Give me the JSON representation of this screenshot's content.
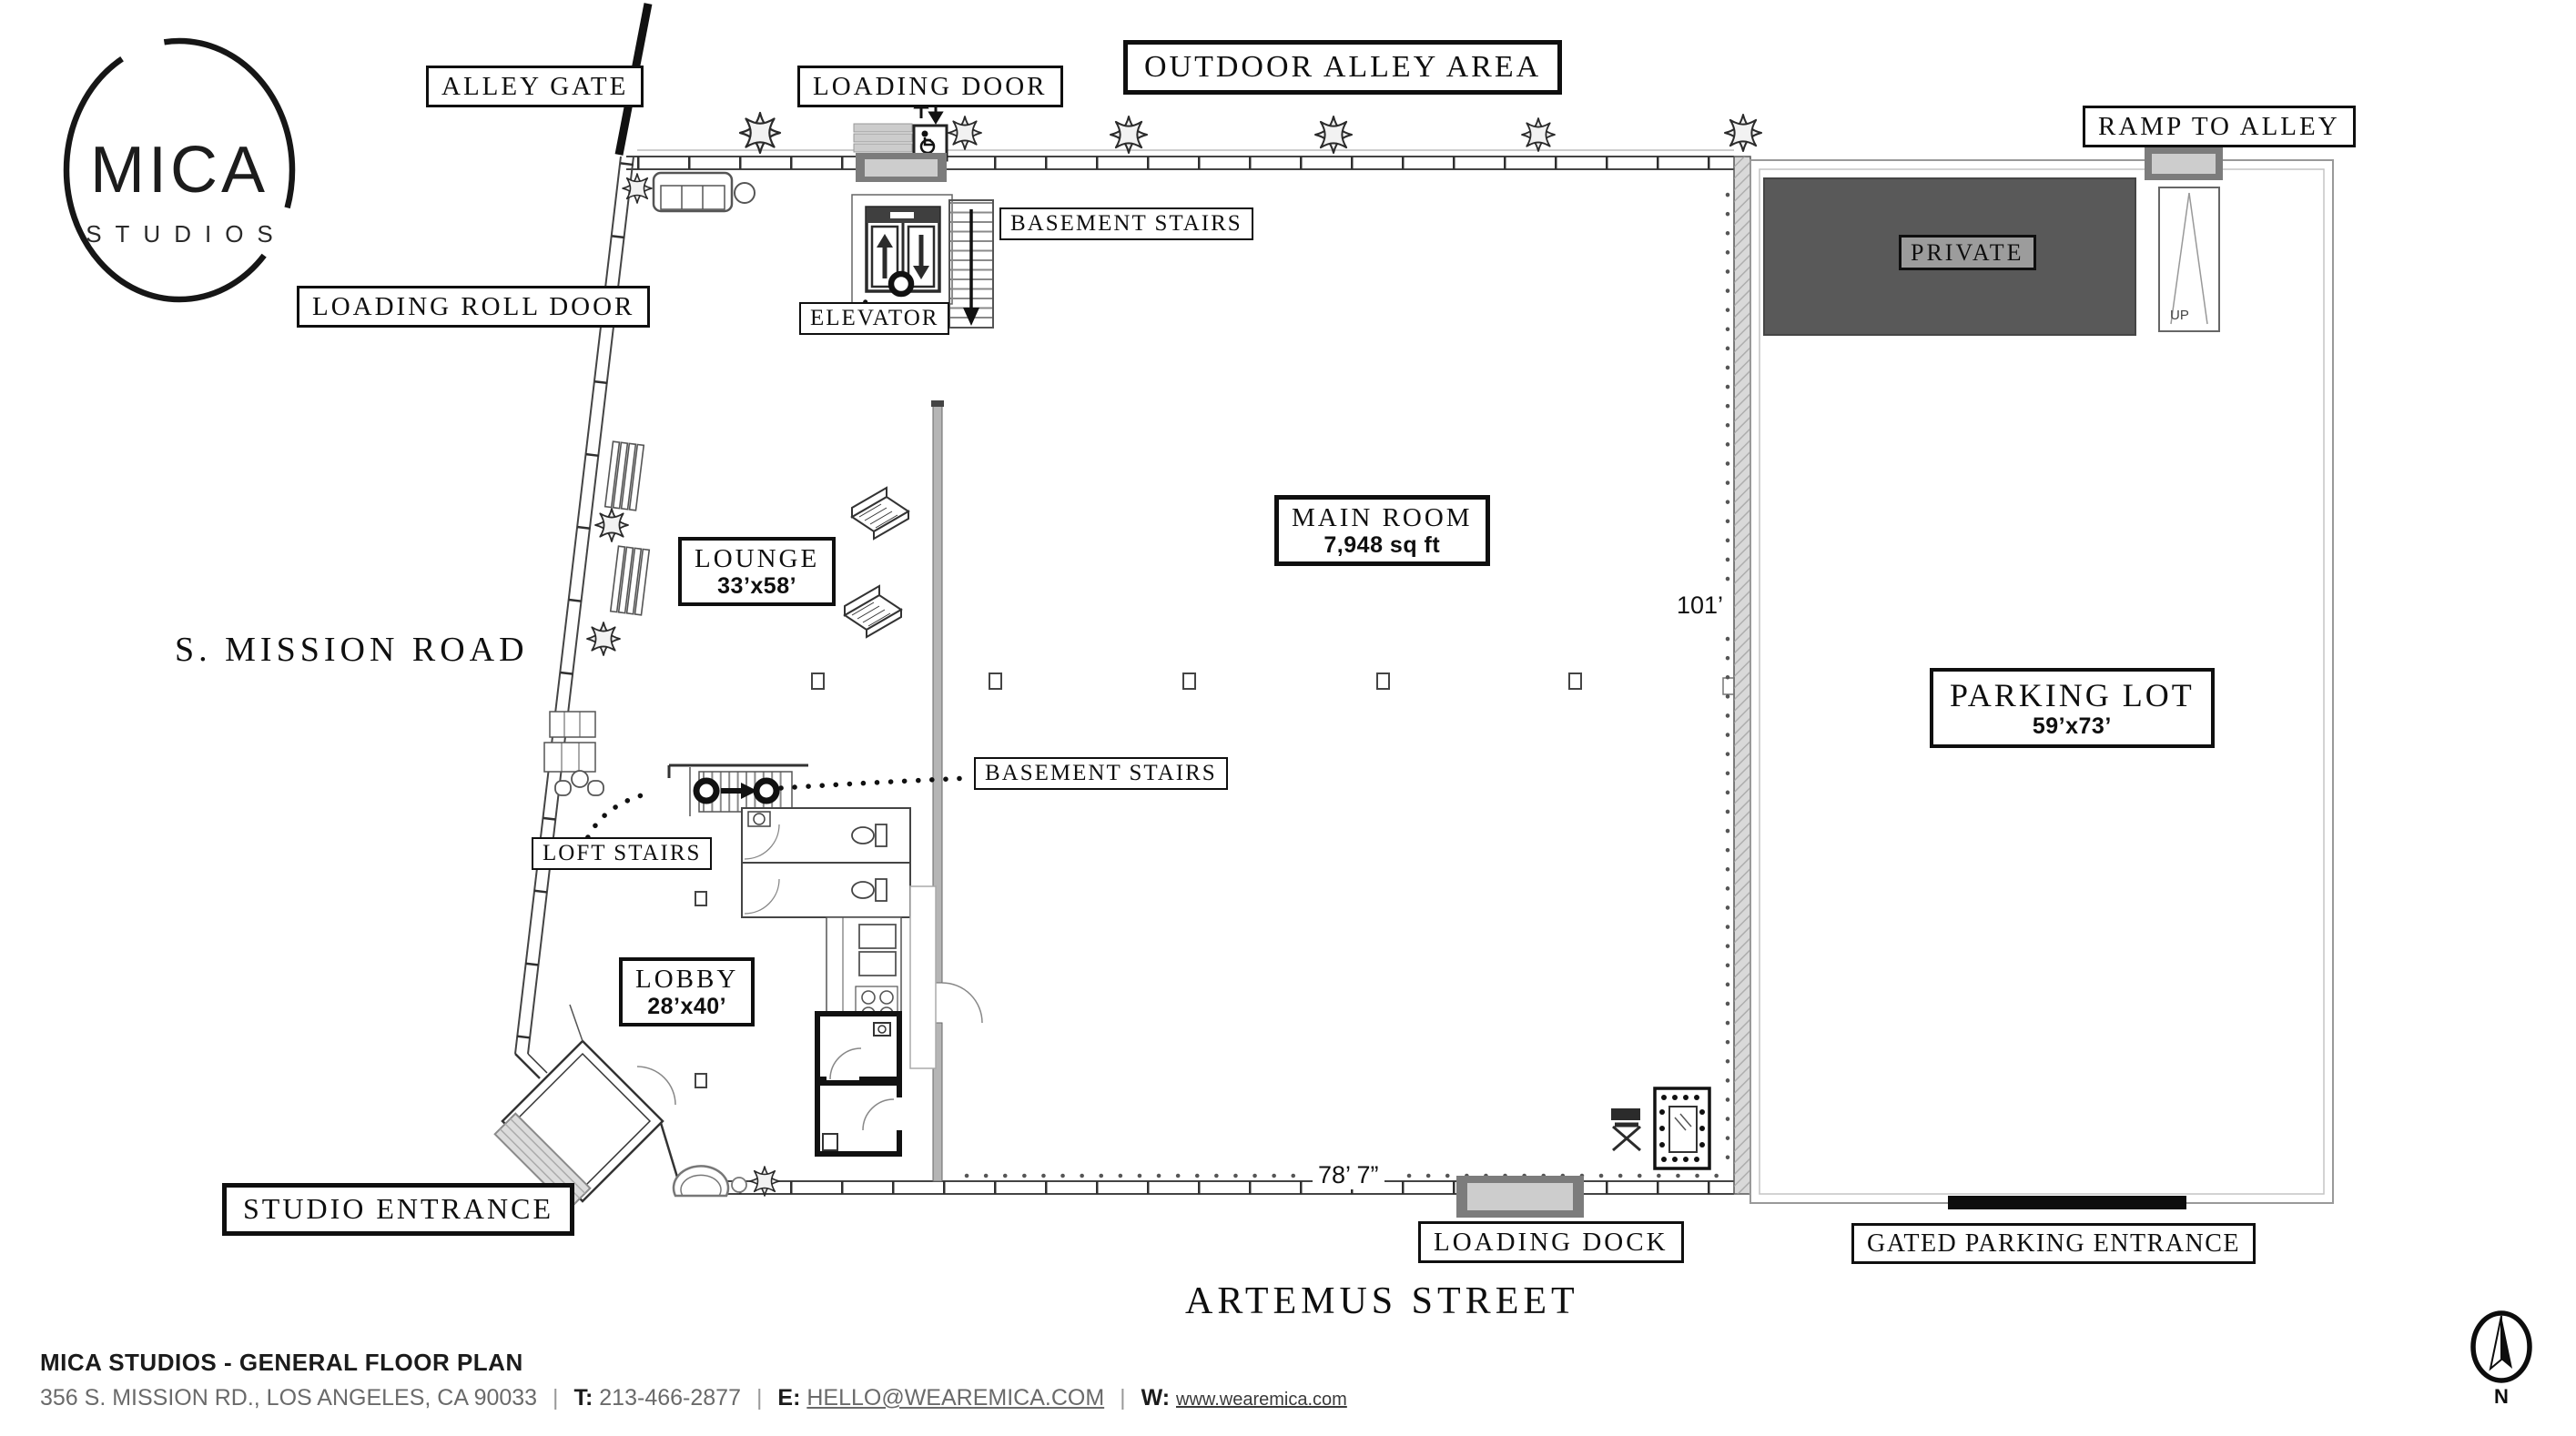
{
  "logo": {
    "title": "MICA",
    "subtitle": "STUDIOS"
  },
  "labels": {
    "alley_gate": "ALLEY GATE",
    "loading_door": "LOADING DOOR",
    "outdoor_alley_area": "OUTDOOR ALLEY AREA",
    "ramp_to_alley": "RAMP TO ALLEY",
    "loading_roll_door": "LOADING ROLL DOOR",
    "basement_stairs_upper": "BASEMENT STAIRS",
    "elevator": "ELEVATOR",
    "private": "PRIVATE",
    "basement_stairs_lower": "BASEMENT STAIRS",
    "loft_stairs": "LOFT STAIRS",
    "studio_entrance": "STUDIO ENTRANCE",
    "loading_dock": "LOADING DOCK",
    "gated_parking_entrance": "GATED PARKING ENTRANCE"
  },
  "rooms": {
    "lounge": {
      "name": "LOUNGE",
      "dimensions": "33’x58’"
    },
    "main_room": {
      "name": "MAIN ROOM",
      "dimensions": "7,948 sq ft"
    },
    "lobby": {
      "name": "LOBBY",
      "dimensions": "28’x40’"
    },
    "parking": {
      "name": "PARKING LOT",
      "dimensions": "59’x73’"
    }
  },
  "streets": {
    "west": "S. MISSION ROAD",
    "south": "ARTEMUS STREET"
  },
  "dimensions": {
    "depth": "101’",
    "width": "78’ 7”",
    "ramp_direction": "UP"
  },
  "compass": {
    "north": "N"
  },
  "footer": {
    "title": "MICA STUDIOS - GENERAL FLOOR PLAN",
    "address": "356 S. MISSION RD., LOS ANGELES, CA 90033",
    "phone_label": "T:",
    "phone": "213-466-2877",
    "email_label": "E:",
    "email": "HELLO@WEAREMICA.COM",
    "web_label": "W:",
    "website": "www.wearemica.com",
    "separator": "|"
  }
}
